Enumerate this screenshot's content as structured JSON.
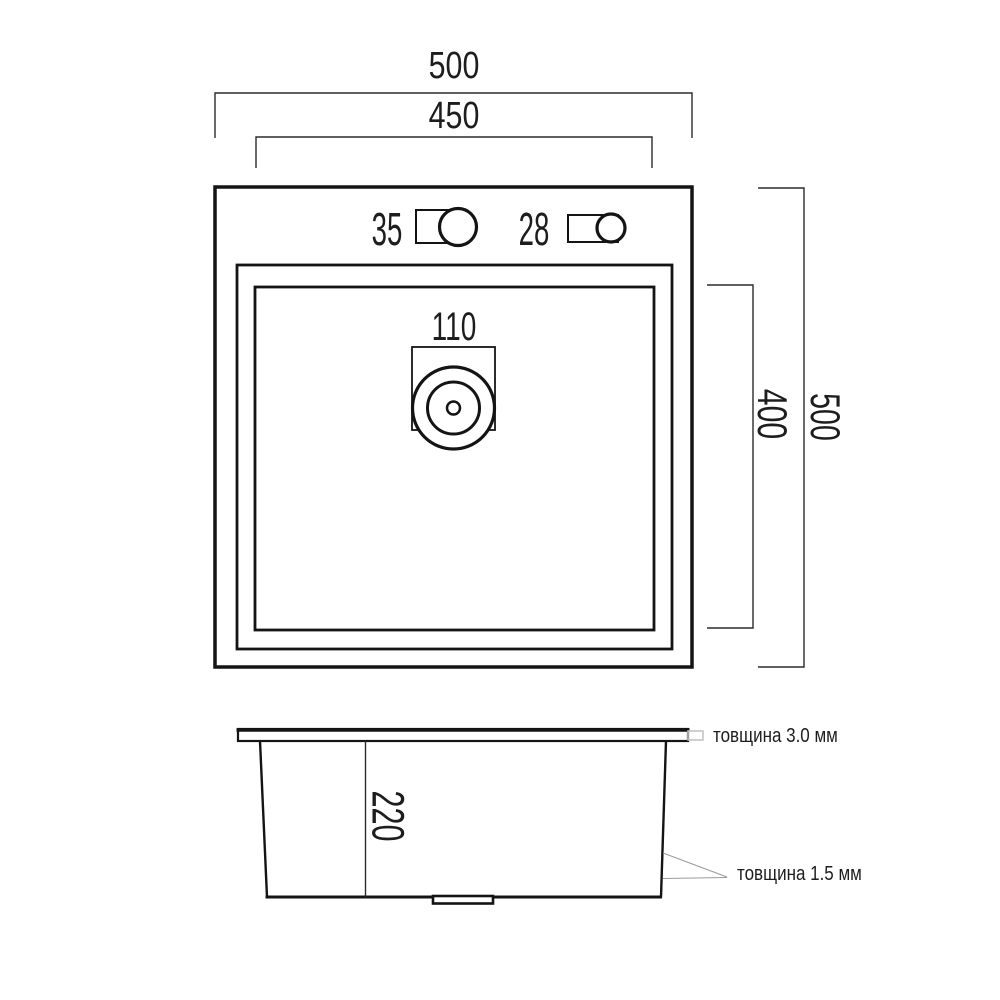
{
  "drawing_title": "sink-dimension-drawing",
  "colors": {
    "line": "#141414",
    "dim_line": "#2b2b2b",
    "leader": "#9a9a9a",
    "highlight_box": "#c4c4c4",
    "background": "#ffffff",
    "text": "#1d1d1d"
  },
  "top_view": {
    "outer_width_label": "500",
    "inner_width_label": "450",
    "outer_height_label": "500",
    "inner_height_label": "400",
    "faucet_hole_label": "35",
    "accessory_hole_label": "28",
    "drain_label": "110"
  },
  "side_view": {
    "depth_label": "220",
    "rim_thickness_label": "товщина 3.0 мм",
    "wall_thickness_label": "товщина 1.5 мм"
  }
}
